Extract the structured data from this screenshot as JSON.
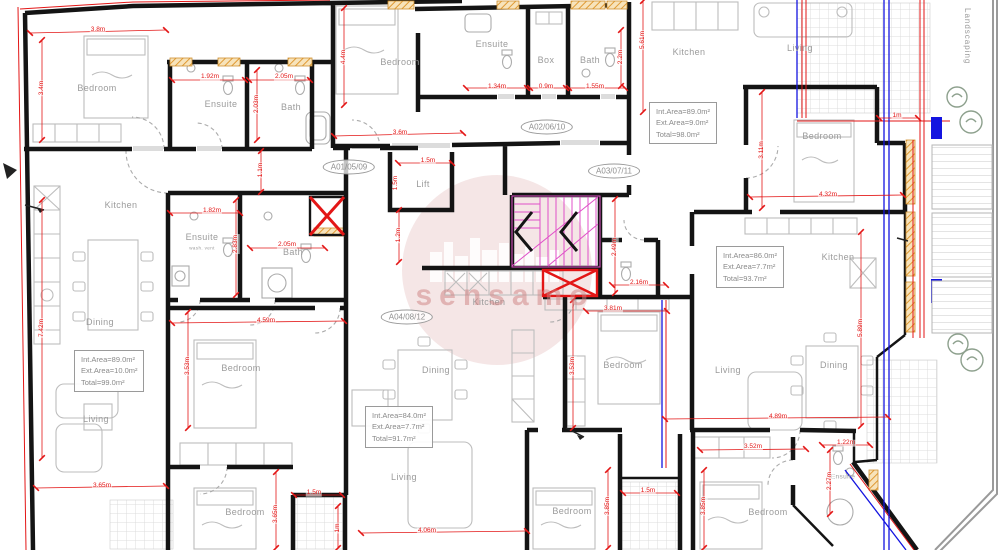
{
  "watermark": {
    "text": "sensamo"
  },
  "side_label": "Landscaping",
  "stamps": [
    {
      "label": "A01/05/09",
      "x": 349,
      "y": 167
    },
    {
      "label": "A02/06/10",
      "x": 547,
      "y": 127
    },
    {
      "label": "A03/07/11",
      "x": 614,
      "y": 171
    },
    {
      "label": "A04/08/12",
      "x": 407,
      "y": 317
    }
  ],
  "area_boxes": [
    {
      "x": 649,
      "y": 102,
      "lines": [
        "Int.Area=89.0m²",
        "Ext.Area=9.0m²",
        "Total=98.0m²"
      ]
    },
    {
      "x": 716,
      "y": 246,
      "lines": [
        "Int.Area=86.0m²",
        "Ext.Area=7.7m²",
        "Total=93.7m²"
      ]
    },
    {
      "x": 74,
      "y": 350,
      "lines": [
        "Int.Area=89.0m²",
        "Ext.Area=10.0m²",
        "Total=99.0m²"
      ]
    },
    {
      "x": 365,
      "y": 406,
      "lines": [
        "Int.Area=84.0m²",
        "Ext.Area=7.7m²",
        "Total=91.7m²"
      ]
    }
  ],
  "rooms": [
    {
      "label": "Bedroom",
      "x": 97,
      "y": 88
    },
    {
      "label": "Ensuite",
      "x": 221,
      "y": 104
    },
    {
      "label": "Bath",
      "x": 291,
      "y": 107
    },
    {
      "label": "Bedroom",
      "x": 400,
      "y": 62
    },
    {
      "label": "Ensuite",
      "x": 492,
      "y": 44
    },
    {
      "label": "Box",
      "x": 546,
      "y": 60
    },
    {
      "label": "Bath",
      "x": 590,
      "y": 60
    },
    {
      "label": "Kitchen",
      "x": 689,
      "y": 52
    },
    {
      "label": "Living",
      "x": 800,
      "y": 48
    },
    {
      "label": "Bedroom",
      "x": 822,
      "y": 136
    },
    {
      "label": "Kitchen",
      "x": 121,
      "y": 205
    },
    {
      "label": "Dining",
      "x": 100,
      "y": 322
    },
    {
      "label": "Living",
      "x": 96,
      "y": 419
    },
    {
      "label": "Ensuite",
      "x": 202,
      "y": 237
    },
    {
      "label": "wash. vent",
      "x": 202,
      "y": 248,
      "fs": 4.5
    },
    {
      "label": "Bath",
      "x": 293,
      "y": 252
    },
    {
      "label": "Lift",
      "x": 423,
      "y": 184
    },
    {
      "label": "Kitchen",
      "x": 489,
      "y": 302
    },
    {
      "label": "Dining",
      "x": 436,
      "y": 370
    },
    {
      "label": "Living",
      "x": 404,
      "y": 477
    },
    {
      "label": "Bedroom",
      "x": 241,
      "y": 368
    },
    {
      "label": "Bedroom",
      "x": 623,
      "y": 365
    },
    {
      "label": "Living",
      "x": 728,
      "y": 370
    },
    {
      "label": "Dining",
      "x": 834,
      "y": 365
    },
    {
      "label": "Kitchen",
      "x": 838,
      "y": 257
    },
    {
      "label": "Bedroom",
      "x": 245,
      "y": 512
    },
    {
      "label": "Bedroom",
      "x": 572,
      "y": 511
    },
    {
      "label": "Bedroom",
      "x": 768,
      "y": 512
    },
    {
      "label": "Ensuite",
      "x": 843,
      "y": 477,
      "fs": 6.5
    }
  ],
  "dimensions": [
    {
      "t": "3.8m",
      "x": 98,
      "y": 30,
      "v": false,
      "line": [
        30,
        33,
        166,
        30
      ]
    },
    {
      "t": "3.4m",
      "x": 42,
      "y": 88,
      "v": true,
      "line": [
        42,
        40,
        42,
        140
      ]
    },
    {
      "t": "1.92m",
      "x": 210,
      "y": 77,
      "v": false,
      "line": [
        172,
        80,
        245,
        80
      ]
    },
    {
      "t": "2.05m",
      "x": 284,
      "y": 77,
      "v": false,
      "line": [
        249,
        80,
        310,
        80
      ]
    },
    {
      "t": "2.03m",
      "x": 257,
      "y": 104,
      "v": true,
      "line": [
        257,
        70,
        257,
        140
      ]
    },
    {
      "t": "1.1m",
      "x": 261,
      "y": 170,
      "v": true,
      "line": [
        261,
        151,
        261,
        192
      ]
    },
    {
      "t": "4.4m",
      "x": 344,
      "y": 57,
      "v": true,
      "line": [
        344,
        8,
        344,
        105
      ]
    },
    {
      "t": "3.6m",
      "x": 400,
      "y": 133,
      "v": false,
      "line": [
        334,
        136,
        463,
        133
      ]
    },
    {
      "t": "1.34m",
      "x": 497,
      "y": 87,
      "v": false,
      "line": [
        466,
        88,
        527,
        88
      ]
    },
    {
      "t": "0.9m",
      "x": 546,
      "y": 87,
      "v": false,
      "line": [
        530,
        88,
        566,
        88
      ]
    },
    {
      "t": "1.55m",
      "x": 595,
      "y": 87,
      "v": false,
      "line": [
        569,
        88,
        625,
        88
      ]
    },
    {
      "t": "2.2m",
      "x": 621,
      "y": 57,
      "v": true,
      "line": [
        621,
        30,
        621,
        86
      ]
    },
    {
      "t": "5.61m",
      "x": 643,
      "y": 40,
      "v": true,
      "line": [
        643,
        1,
        643,
        112
      ]
    },
    {
      "t": "1.5m",
      "x": 428,
      "y": 161,
      "v": false,
      "line": [
        398,
        163,
        452,
        163
      ]
    },
    {
      "t": "1.5m",
      "x": 396,
      "y": 183,
      "v": true,
      "line": null
    },
    {
      "t": "1.82m",
      "x": 212,
      "y": 211,
      "v": false,
      "line": [
        170,
        213,
        240,
        213
      ]
    },
    {
      "t": "2.83m",
      "x": 236,
      "y": 244,
      "v": true,
      "line": [
        236,
        200,
        236,
        295
      ]
    },
    {
      "t": "2.05m",
      "x": 287,
      "y": 245,
      "v": false,
      "line": [
        250,
        248,
        325,
        248
      ]
    },
    {
      "t": "1.2m",
      "x": 399,
      "y": 235,
      "v": true,
      "line": [
        399,
        210,
        399,
        262
      ]
    },
    {
      "t": "2.49m",
      "x": 615,
      "y": 247,
      "v": true,
      "line": [
        615,
        199,
        615,
        293
      ]
    },
    {
      "t": "2.16m",
      "x": 639,
      "y": 283,
      "v": false,
      "line": [
        612,
        285,
        666,
        285
      ]
    },
    {
      "t": "4.59m",
      "x": 266,
      "y": 321,
      "v": false,
      "line": [
        172,
        323,
        344,
        321
      ]
    },
    {
      "t": "3.81m",
      "x": 613,
      "y": 309,
      "v": false,
      "line": [
        586,
        311,
        667,
        311
      ]
    },
    {
      "t": "3.53m",
      "x": 188,
      "y": 366,
      "v": true,
      "line": [
        188,
        312,
        188,
        428
      ]
    },
    {
      "t": "3.53m",
      "x": 573,
      "y": 366,
      "v": true,
      "line": [
        573,
        300,
        573,
        428
      ]
    },
    {
      "t": "3.11m",
      "x": 762,
      "y": 150,
      "v": true,
      "line": [
        762,
        92,
        762,
        208
      ]
    },
    {
      "t": "4.32m",
      "x": 828,
      "y": 195,
      "v": false,
      "line": [
        750,
        197,
        903,
        195
      ]
    },
    {
      "t": "1m",
      "x": 897,
      "y": 116,
      "v": false,
      "line": [
        879,
        118,
        918,
        118
      ]
    },
    {
      "t": "7.42m",
      "x": 42,
      "y": 328,
      "v": true,
      "line": [
        42,
        200,
        42,
        458
      ]
    },
    {
      "t": "5.89m",
      "x": 861,
      "y": 328,
      "v": true,
      "line": [
        861,
        232,
        861,
        426
      ]
    },
    {
      "t": "3.65m",
      "x": 102,
      "y": 486,
      "v": false,
      "line": [
        36,
        488,
        166,
        486
      ]
    },
    {
      "t": "3.65m",
      "x": 276,
      "y": 514,
      "v": true,
      "line": [
        276,
        472,
        276,
        548
      ]
    },
    {
      "t": "1m",
      "x": 338,
      "y": 528,
      "v": true,
      "line": [
        338,
        506,
        338,
        548
      ]
    },
    {
      "t": "4.06m",
      "x": 427,
      "y": 531,
      "v": false,
      "line": [
        361,
        533,
        527,
        531
      ]
    },
    {
      "t": "1.5m",
      "x": 314,
      "y": 493,
      "v": false,
      "line": [
        294,
        495,
        342,
        495
      ]
    },
    {
      "t": "1.5m",
      "x": 648,
      "y": 491,
      "v": false,
      "line": [
        623,
        493,
        677,
        493
      ]
    },
    {
      "t": "3.85m",
      "x": 608,
      "y": 506,
      "v": true,
      "line": [
        608,
        470,
        608,
        548
      ]
    },
    {
      "t": "3.85m",
      "x": 704,
      "y": 506,
      "v": true,
      "line": [
        704,
        470,
        704,
        548
      ]
    },
    {
      "t": "4.89m",
      "x": 778,
      "y": 417,
      "v": false,
      "line": [
        665,
        419,
        888,
        417
      ]
    },
    {
      "t": "3.52m",
      "x": 753,
      "y": 447,
      "v": false,
      "line": [
        700,
        450,
        806,
        449
      ]
    },
    {
      "t": "1.22m",
      "x": 846,
      "y": 443,
      "v": false,
      "line": [
        822,
        445,
        870,
        445
      ]
    },
    {
      "t": "2.27m",
      "x": 830,
      "y": 481,
      "v": true,
      "line": [
        830,
        450,
        830,
        514
      ]
    }
  ]
}
